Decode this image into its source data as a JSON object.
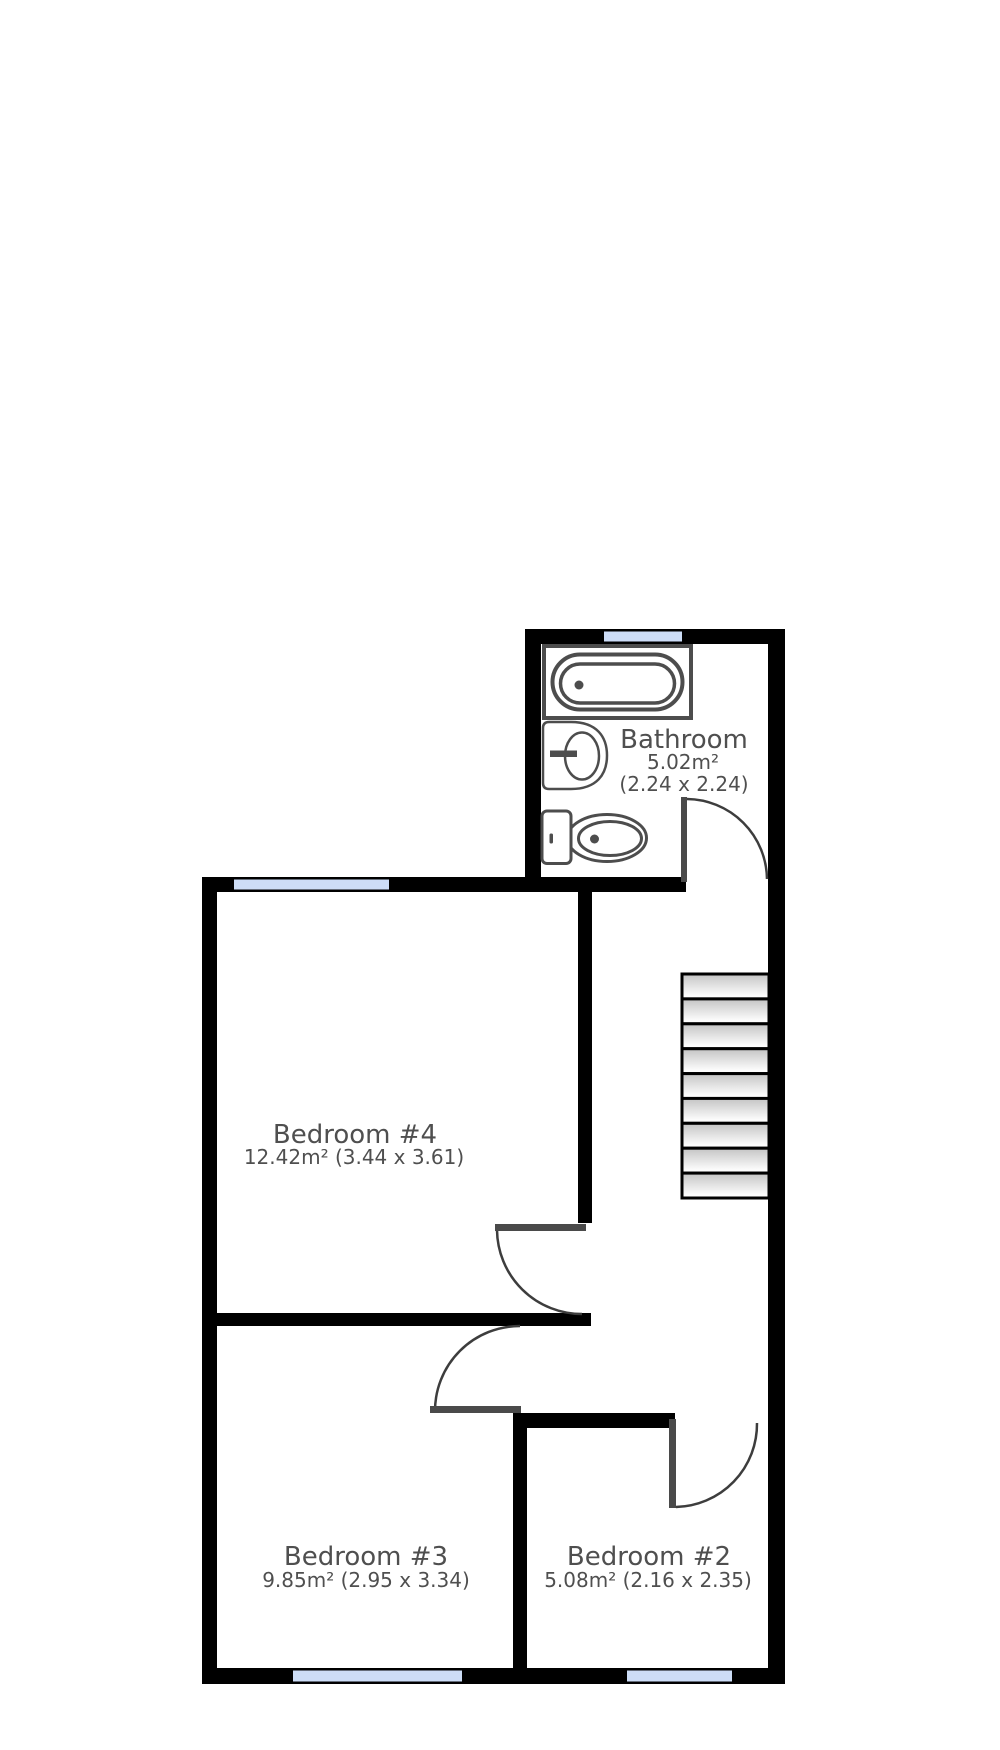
{
  "floorplan": {
    "rooms": {
      "bathroom": {
        "name": "Bathroom",
        "area": "5.02m²",
        "dimensions": "(2.24 x 2.24)"
      },
      "bedroom4": {
        "name": "Bedroom #4",
        "details": "12.42m² (3.44 x 3.61)"
      },
      "bedroom3": {
        "name": "Bedroom #3",
        "details": "9.85m² (2.95 x 3.34)"
      },
      "bedroom2": {
        "name": "Bedroom #2",
        "details": "5.08m² (2.16 x 2.35)"
      }
    },
    "fixtures": [
      {
        "name": "bathtub"
      },
      {
        "name": "sink"
      },
      {
        "name": "toilet"
      },
      {
        "name": "staircase",
        "treads": 9
      }
    ],
    "windows": [
      {
        "location": "bathroom-top"
      },
      {
        "location": "bedroom4-top"
      },
      {
        "location": "bedroom3-bottom"
      },
      {
        "location": "bedroom2-bottom"
      }
    ],
    "doors": [
      {
        "room": "bathroom"
      },
      {
        "room": "bedroom4"
      },
      {
        "room": "bedroom3"
      },
      {
        "room": "bedroom2"
      }
    ],
    "colors": {
      "wall": "#000000",
      "window": "#cdddf7",
      "label": "#4f4f4f",
      "fixture_outline": "#4d4d4d",
      "door_leaf": "#4a4a4a",
      "door_arc": "#3d3d3d"
    }
  }
}
